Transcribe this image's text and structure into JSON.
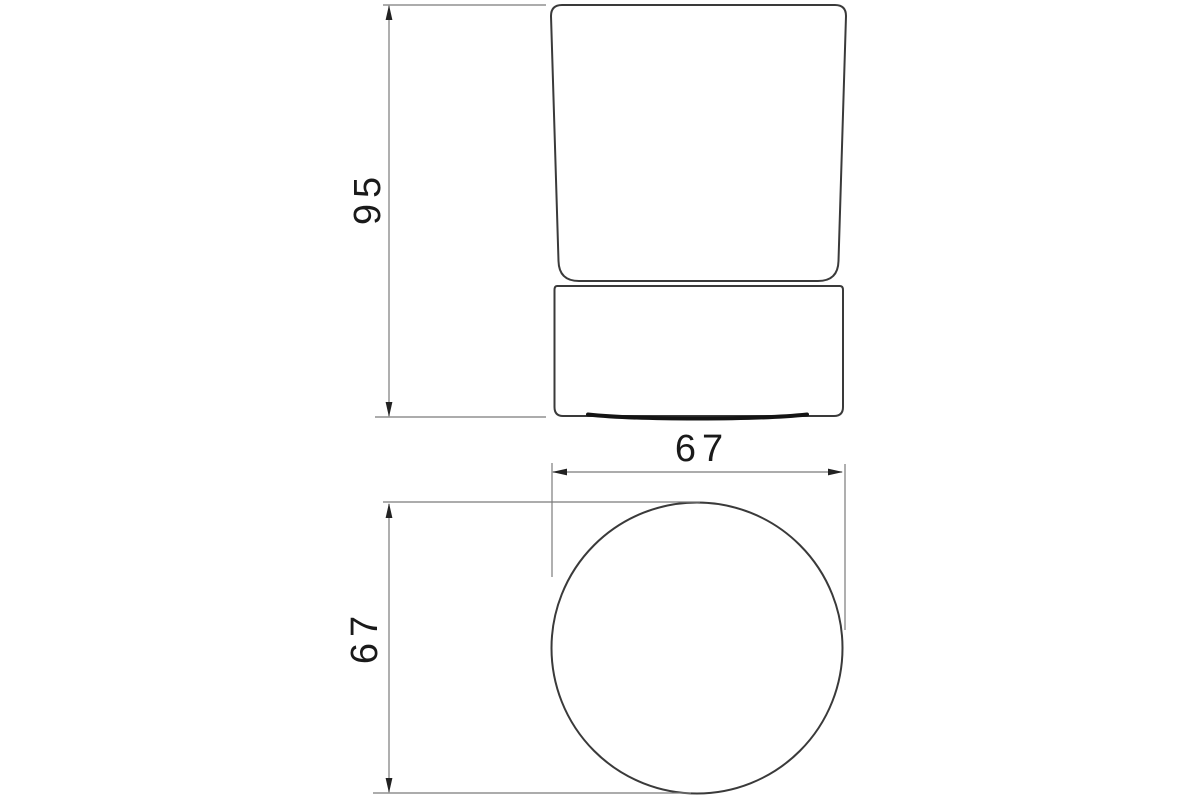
{
  "drawing": {
    "type": "technical-dimension-drawing",
    "views": {
      "front_view": "elevation of cylindrical tumbler on round base",
      "plan_view": "top view circle"
    },
    "dimensions": {
      "front_height": {
        "value": "95"
      },
      "plan_width": {
        "value": "67"
      },
      "plan_depth": {
        "value": "67"
      }
    },
    "colors": {
      "background": "#ffffff",
      "object_line": "#3a3a3a",
      "dim_line": "#7a7a7a",
      "arrow": "#222222",
      "text": "#1a1a1a",
      "shadow": "#141414"
    }
  }
}
